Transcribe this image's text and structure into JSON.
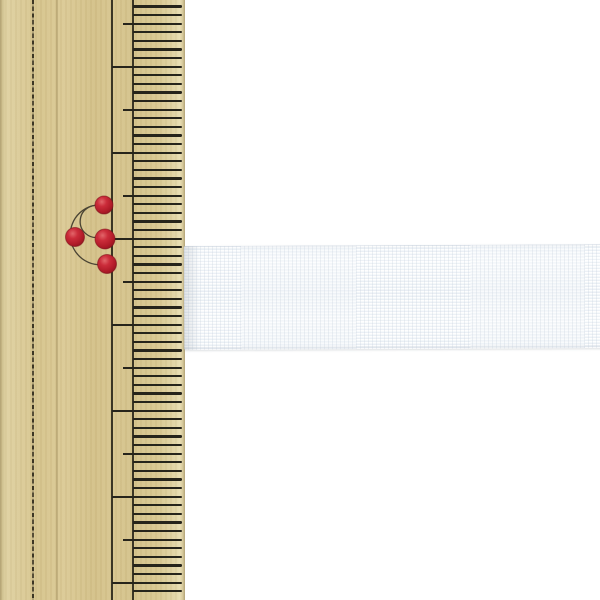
{
  "scene": {
    "type": "product-photo",
    "subject": "White woven tape laid horizontally against a vertical wooden ruler; tape width spans about 1.2 cm on the ruler scale",
    "background_color": "#ffffff"
  },
  "ruler": {
    "orientation": "vertical",
    "side": "left",
    "width_px": 185,
    "wood_color": "#d8c48e",
    "tick_color": "#26241b",
    "scored_line_x": 32,
    "guide_line_cm_x": 111,
    "guide_line_mm_x": 132,
    "ticks": {
      "start_y": 6.5,
      "spacing_px": 8.6,
      "count": 69,
      "cm_index_mod": 7,
      "half_cm_index_mod": 2,
      "mm_left": 133,
      "half_cm_left": 123,
      "cm_left": 112,
      "right": 182,
      "thickness": 2.4
    },
    "red_mark": {
      "dot_color": "#c02130",
      "arc_color": "#4a4434",
      "dots": [
        {
          "cx": 104,
          "cy": 205,
          "r": 9
        },
        {
          "cx": 75,
          "cy": 237,
          "r": 9.5
        },
        {
          "cx": 105,
          "cy": 239,
          "r": 10
        },
        {
          "cx": 107,
          "cy": 264,
          "r": 9.5
        }
      ],
      "arcs": [
        "M104 205 A30 30 0 1 0 107 264",
        "M103 207 A16 16 0 1 0 100 237"
      ]
    }
  },
  "tape": {
    "base_color": "#f5f8fa",
    "edge_color": "#c9ced5",
    "left_px": 184,
    "top_px": 246,
    "height_px": 104
  }
}
